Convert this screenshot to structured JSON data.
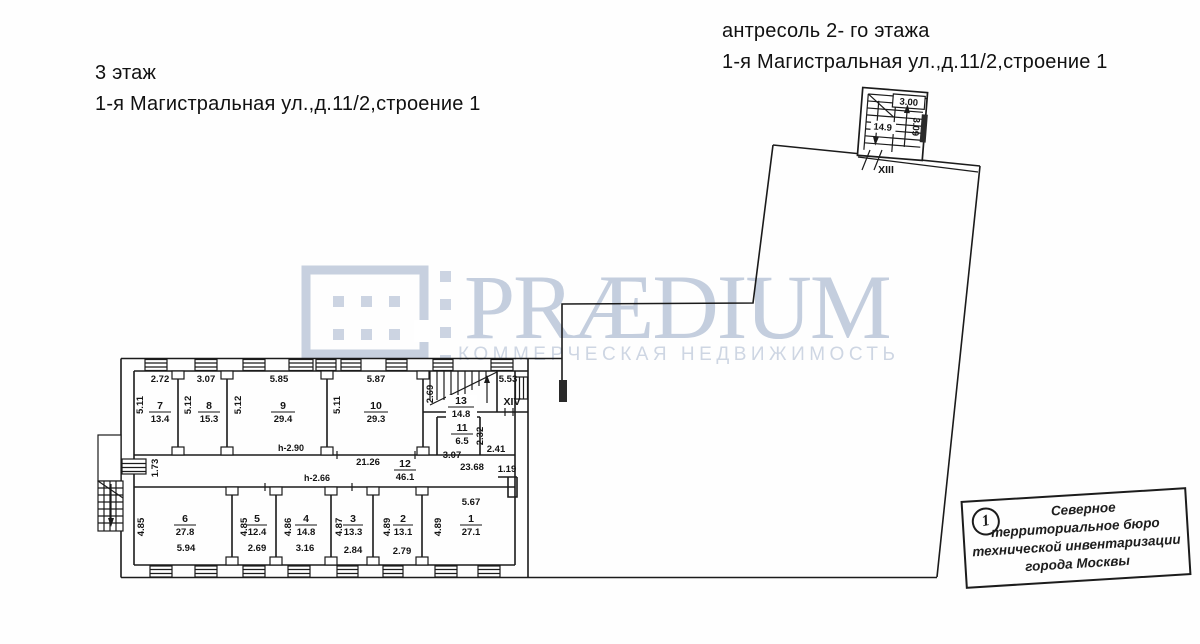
{
  "header_left": {
    "line1": "3 этаж",
    "line2": "1-я Магистральная ул.,д.11/2,строение 1"
  },
  "header_right": {
    "line1": "антресоль 2- го  этажа",
    "line2": "1-я Магистральная ул.,д.11/2,строение 1"
  },
  "watermark": {
    "brand": "PRÆDIUM",
    "tagline": "КОММЕРЧЕСКАЯ НЕДВИЖИМОСТЬ",
    "brand_color": "#c4cede",
    "tagline_color": "#ced6e3"
  },
  "stamp": {
    "number": "1",
    "lines": [
      "Северное",
      "территориальное бюро",
      "технической инвентаризации",
      "города Москвы"
    ]
  },
  "plan": {
    "ink_color": "#1b1b1b",
    "rooms": {
      "r7": {
        "num": "7",
        "area": "13.4",
        "w": "2.72",
        "h": "5.11"
      },
      "r8": {
        "num": "8",
        "area": "15.3",
        "w": "3.07",
        "h": "5.12"
      },
      "r9": {
        "num": "9",
        "area": "29.4",
        "w": "5.85",
        "h": "5.12",
        "ceiling": "h-2.90"
      },
      "r10": {
        "num": "10",
        "area": "29.3",
        "w": "5.87",
        "h": "5.11"
      },
      "r13": {
        "num": "13",
        "area": "14.8",
        "w": "5.53",
        "h": "2.69"
      },
      "r11": {
        "num": "11",
        "area": "6.5",
        "w": "3.07",
        "h": "2.32",
        "side": "2.41"
      },
      "r12": {
        "num": "12",
        "area": "46.1",
        "d1": "21.26",
        "d2": "23.68",
        "d3": "1.19",
        "d4": "1.73",
        "ceiling": "h-2.66"
      },
      "r6": {
        "num": "6",
        "area": "27.8",
        "w": "5.94",
        "h": "4.85"
      },
      "r5": {
        "num": "5",
        "area": "12.4",
        "w": "2.69",
        "h": "4.85"
      },
      "r4": {
        "num": "4",
        "area": "14.8",
        "w": "3.16",
        "h": "4.86"
      },
      "r3": {
        "num": "3",
        "area": "13.3",
        "w": "2.84",
        "h": "4.87"
      },
      "r2": {
        "num": "2",
        "area": "13.1",
        "w": "2.79",
        "h": "4.89"
      },
      "r1": {
        "num": "1",
        "area": "27.1",
        "w": "5.67",
        "h": "4.89"
      }
    },
    "stairs": {
      "xiii": {
        "label": "XIII",
        "rise": "3.00",
        "mid": "14.9",
        "run": "3.09"
      },
      "xiv": {
        "label": "XIV"
      }
    }
  }
}
